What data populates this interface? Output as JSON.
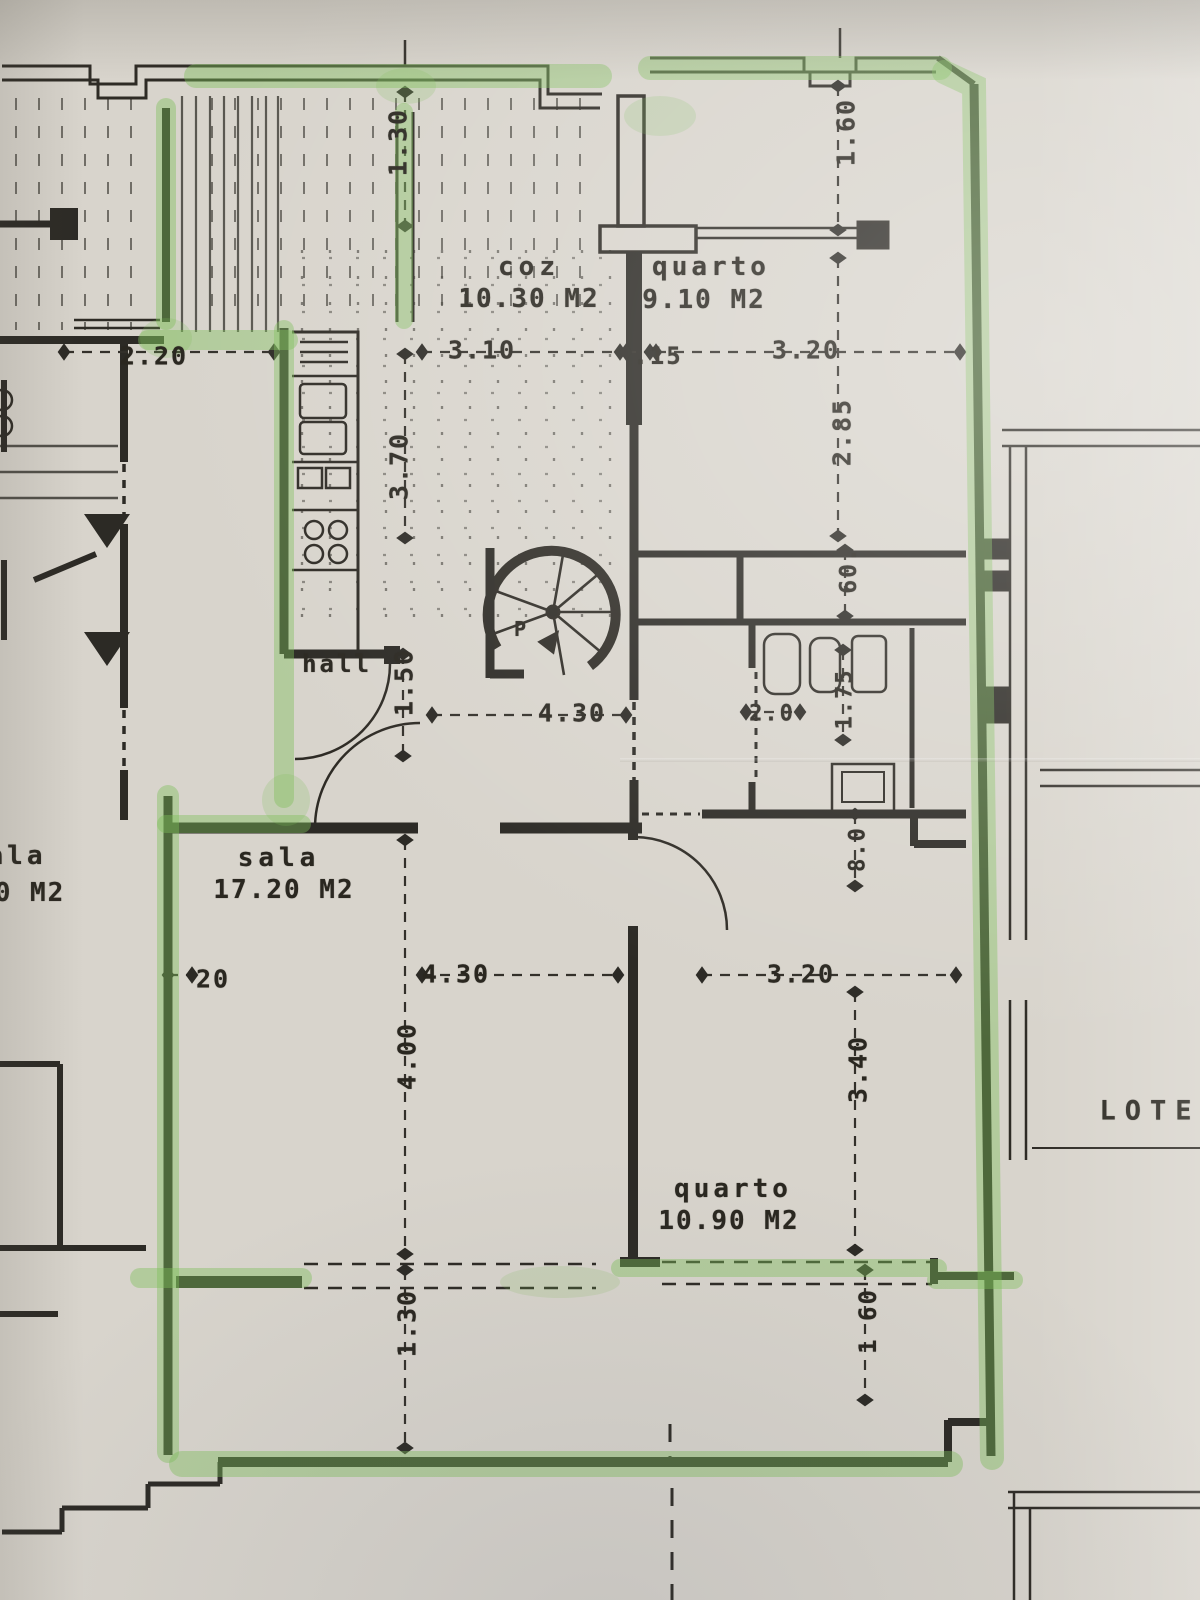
{
  "rooms": [
    {
      "name": "coz",
      "area": "10.30 M2"
    },
    {
      "name": "quarto",
      "area": "9.10 M2"
    },
    {
      "name": "sala",
      "area": "17.20 M2"
    },
    {
      "name": "quarto",
      "area": "10.90 M2"
    },
    {
      "name": "hall",
      "area": ""
    },
    {
      "name": "ala",
      "area": "0 M2"
    }
  ],
  "dimensions": {
    "terrace_top": "1.30",
    "terrace_top_right": "1.60",
    "left_width": "2.20",
    "kitchen_width": "3.10",
    "wall_thickness": ".15",
    "quarto1_width": "3.20",
    "kitchen_depth": "3.70",
    "quarto1_depth": "2.85",
    "closet_depth": "60.",
    "hall_width": "1.50",
    "hall_length": "4.30",
    "door_width": "2.0",
    "wc_width": "1.75",
    "wc_depth": "8.0",
    "sala_wall": "20",
    "sala_width": "4.30",
    "sala_depth": "4.00",
    "quarto2_width": "3.20",
    "quarto2_depth": "3.40",
    "balcony_left": "1.30",
    "balcony_right": "1 60"
  },
  "annotations": {
    "lot_label": "LOTE",
    "stair_label": "P"
  },
  "colors": {
    "highlighter": "#7fbe5a",
    "ink": "#2c2a25",
    "paper": "#d8d4cc"
  }
}
